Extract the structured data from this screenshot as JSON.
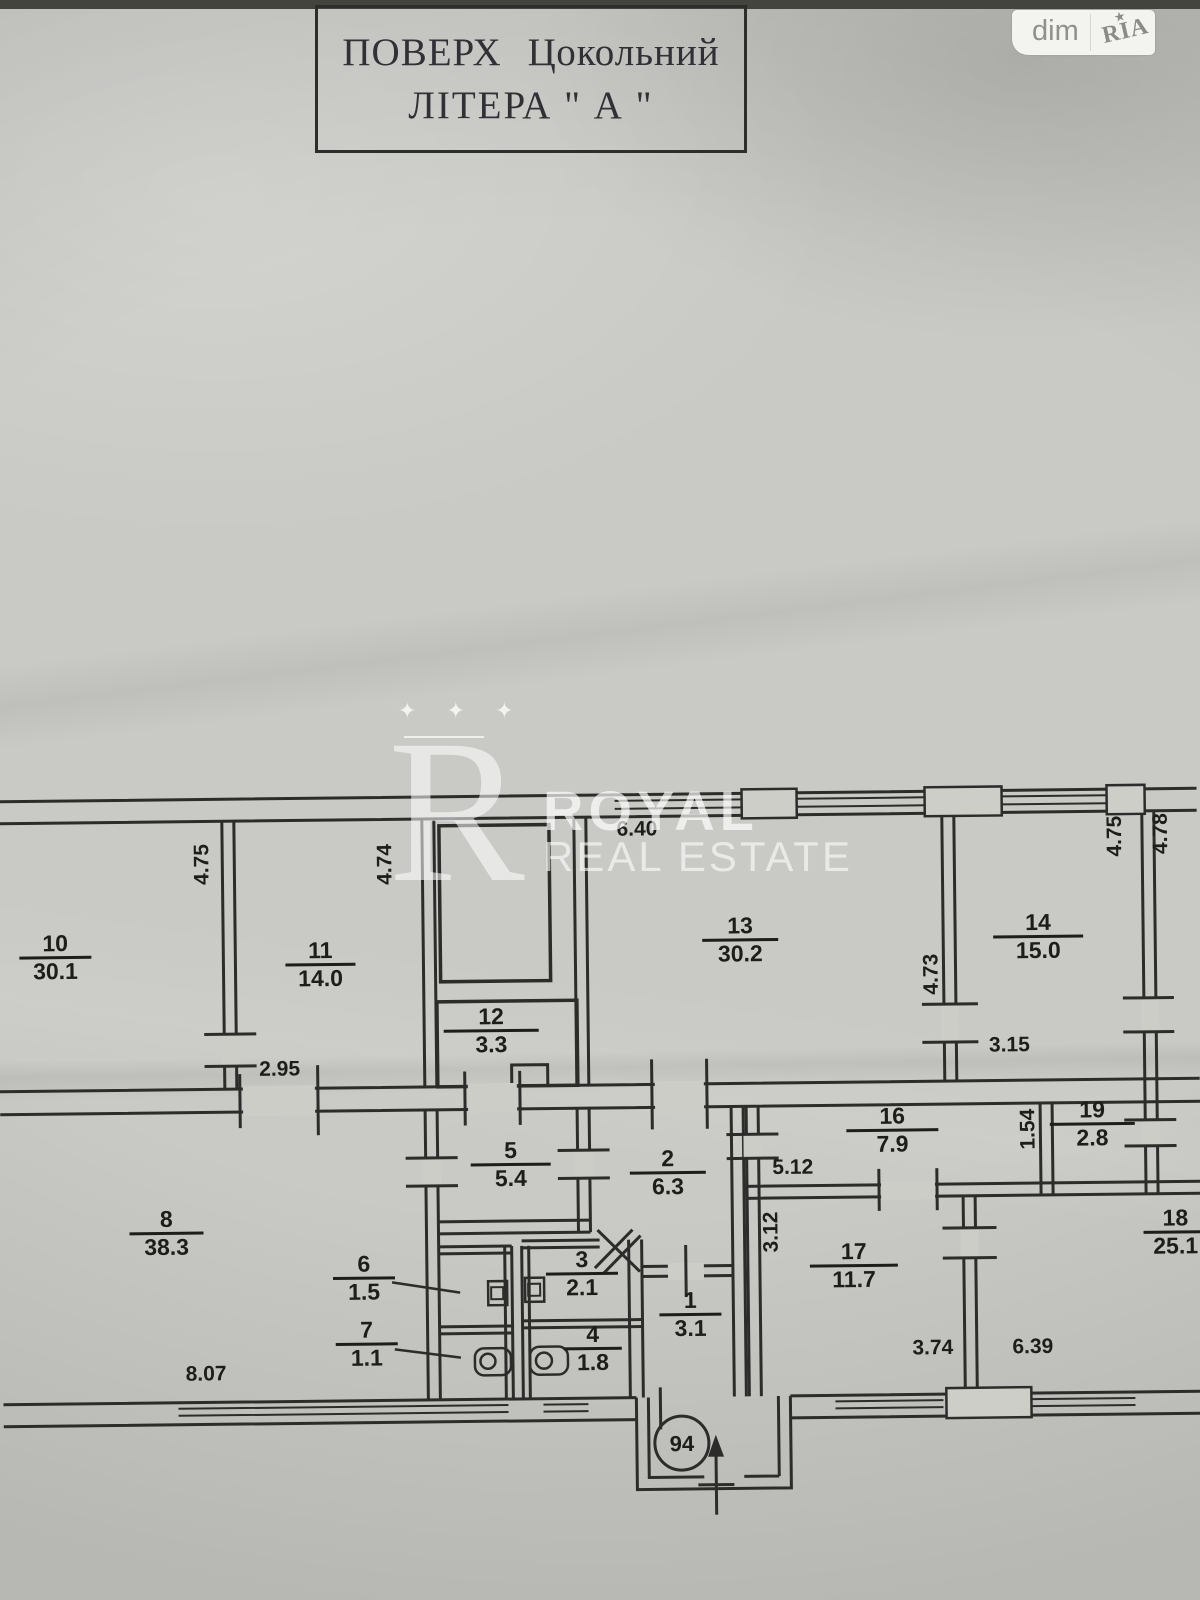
{
  "logo": {
    "dim": "dim",
    "ria": "RIA",
    "star": "★"
  },
  "title_block": {
    "word1": "ПОВЕРХ",
    "word2": "Цокольний",
    "line2": "ЛІТЕРА \" А \""
  },
  "watermark": {
    "stars": "✦ ✦ ✦",
    "monogram": "R",
    "brand_line1": "ROYAL",
    "brand_line2": "REAL ESTATE"
  },
  "plan": {
    "rooms": [
      {
        "number": "10",
        "area": "30.1"
      },
      {
        "number": "11",
        "area": "14.0"
      },
      {
        "number": "12",
        "area": "3.3"
      },
      {
        "number": "13",
        "area": "30.2"
      },
      {
        "number": "14",
        "area": "15.0"
      },
      {
        "number": "8",
        "area": "38.3"
      },
      {
        "number": "5",
        "area": "5.4"
      },
      {
        "number": "2",
        "area": "6.3"
      },
      {
        "number": "16",
        "area": "7.9"
      },
      {
        "number": "19",
        "area": "2.8"
      },
      {
        "number": "17",
        "area": "11.7"
      },
      {
        "number": "18",
        "area": "25.1"
      },
      {
        "number": "6",
        "area": "1.5"
      },
      {
        "number": "7",
        "area": "1.1"
      },
      {
        "number": "3",
        "area": "2.1"
      },
      {
        "number": "4",
        "area": "1.8"
      },
      {
        "number": "1",
        "area": "3.1"
      }
    ],
    "dimensions": [
      "4.75",
      "4.74",
      "6.40",
      "4.75",
      "4.78",
      "4.73",
      "3.15",
      "2.95",
      "5.12",
      "1.54",
      "3.12",
      "8.07",
      "3.74",
      "6.39"
    ],
    "entrance_number": "94"
  },
  "colors": {
    "paper": "#c9c9c5",
    "ink": "#242422",
    "watermark": "#ffffff"
  }
}
